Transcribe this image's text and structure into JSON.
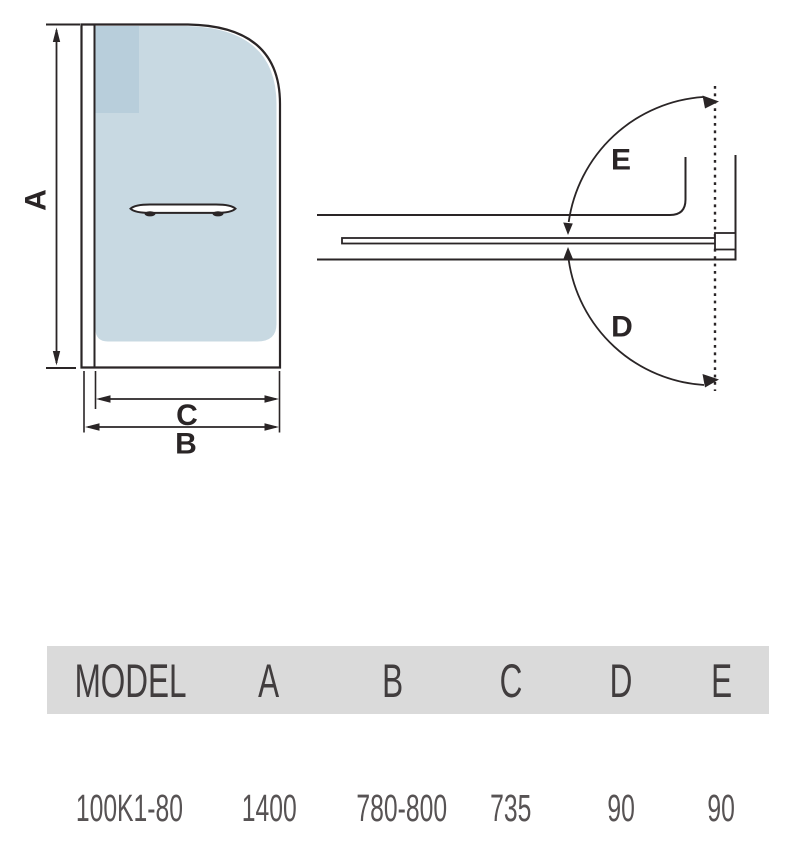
{
  "diagram": {
    "labels": {
      "a": "A",
      "b": "B",
      "c": "C",
      "d": "D",
      "e": "E"
    }
  },
  "table": {
    "headers": {
      "model": "MODEL",
      "a": "A",
      "b": "B",
      "c": "C",
      "d": "D",
      "e": "E"
    },
    "row": {
      "model": "100K1-80",
      "a": "1400",
      "b": "780-800",
      "c": "735",
      "d": "90",
      "e": "90"
    }
  },
  "colors": {
    "line": "#2a2526",
    "glass": "#c8d9e2",
    "glass_shade": "#b8cedb",
    "table_header_bg": "#dadada",
    "table_header_text": "#413d3e",
    "table_value_text": "#575354"
  }
}
